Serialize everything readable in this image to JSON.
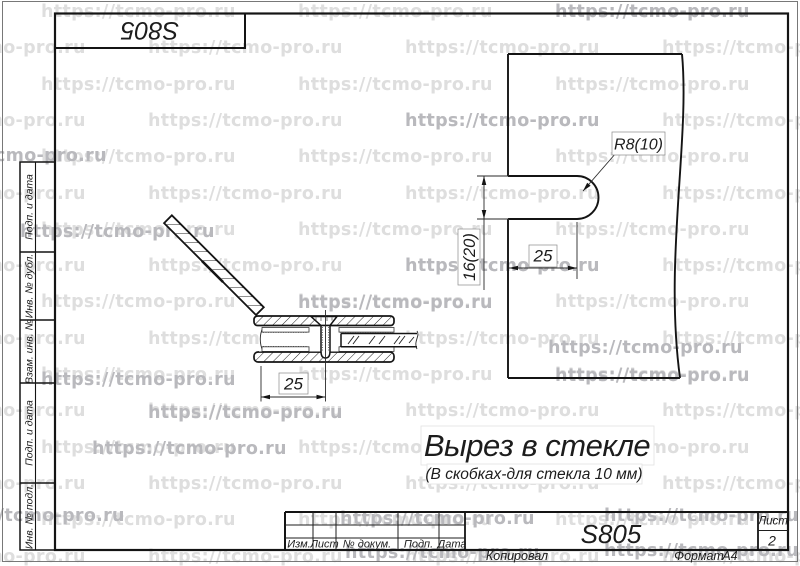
{
  "watermark": {
    "text": "https://tcmo-pro.ru",
    "light_color": "#dedede",
    "dark_color": "#b9b9bd",
    "row_start": 2,
    "row_step": 36.3,
    "col_step": 257,
    "row_count": 16,
    "offsets": [
      41,
      148
    ],
    "dark_positions": [
      {
        "x": 555,
        "y": 2
      },
      {
        "x": 405,
        "y": 111
      },
      {
        "x": -88,
        "y": 146
      },
      {
        "x": 20,
        "y": 222
      },
      {
        "x": 405,
        "y": 256
      },
      {
        "x": 298,
        "y": 293
      },
      {
        "x": 548,
        "y": 338
      },
      {
        "x": 41,
        "y": 370
      },
      {
        "x": 555,
        "y": 366
      },
      {
        "x": 148,
        "y": 403
      },
      {
        "x": 92,
        "y": 439
      },
      {
        "x": -70,
        "y": 506
      },
      {
        "x": 340,
        "y": 509
      },
      {
        "x": 604,
        "y": 506
      },
      {
        "x": 345,
        "y": 543
      },
      {
        "x": 604,
        "y": 541
      }
    ]
  },
  "corner_stamp": {
    "code": "S805"
  },
  "side_column": {
    "blocks": [
      {
        "label": "Подп. и дата"
      },
      {
        "label": "Инв. № дубл."
      },
      {
        "label": "Взам. инв. №"
      },
      {
        "label": "Подп. и дата"
      },
      {
        "label": "Инв. № подл."
      }
    ]
  },
  "drawing": {
    "section_view": {
      "width_dim": "25"
    },
    "cutout_view": {
      "radius_dim": "R8(10)",
      "height_dim": "16(20)",
      "depth_dim": "25"
    },
    "title": "Вырез в стекле",
    "subtitle": "(В скобках-для стекла 10 мм)"
  },
  "title_block": {
    "columns": [
      "Изм.",
      "Лист",
      "№ докум.",
      "Подп.",
      "Дата"
    ],
    "doc_number": "S805",
    "sheet_label": "Лист",
    "sheet_value": "2",
    "footer": {
      "copied": "Копировал",
      "format_label": "Формат",
      "format_value": "А4"
    }
  }
}
